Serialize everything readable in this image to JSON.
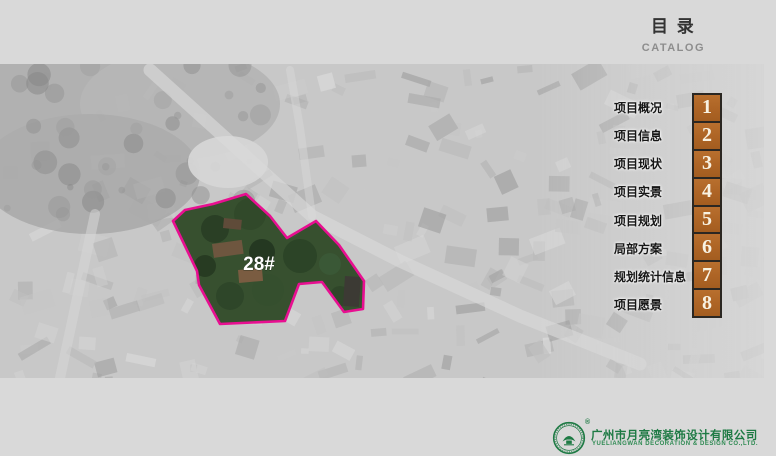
{
  "header": {
    "title": "目 录",
    "subtitle": "CATALOG"
  },
  "map": {
    "site_label": "28#",
    "outline_color": "#e80f91"
  },
  "menu": {
    "number_box_color": "#ad6425",
    "items": [
      {
        "number": "1",
        "label": "项目概况"
      },
      {
        "number": "2",
        "label": "项目信息"
      },
      {
        "number": "3",
        "label": "项目现状"
      },
      {
        "number": "4",
        "label": "项目实景"
      },
      {
        "number": "5",
        "label": "项目规划"
      },
      {
        "number": "6",
        "label": "局部方案"
      },
      {
        "number": "7",
        "label": "规划统计信息"
      },
      {
        "number": "8",
        "label": "项目愿景"
      }
    ]
  },
  "footer": {
    "registered_mark": "®",
    "company_cn": "广州市月亮湾装饰设计有限公司",
    "company_en": "YUELIANGWAN DECORATION & DESIGN CO.,LTD.",
    "brand_color": "#1e7a44"
  }
}
